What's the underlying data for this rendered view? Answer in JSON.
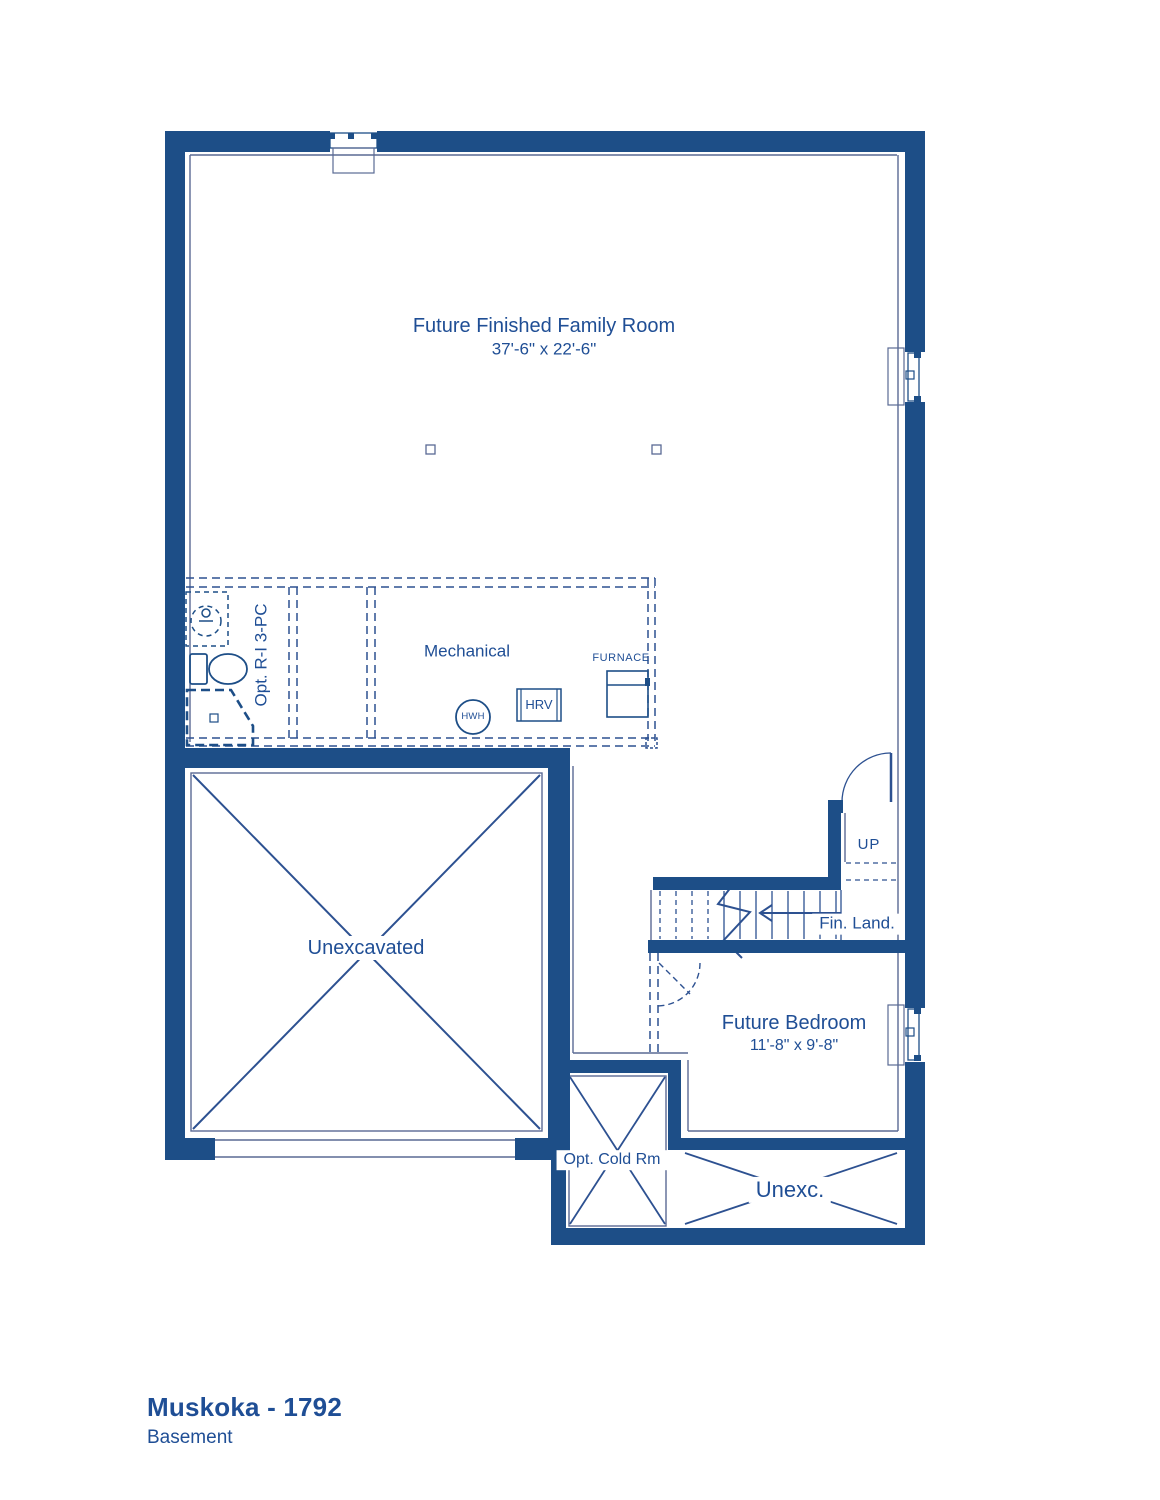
{
  "title": {
    "name": "Muskoka - 1792",
    "floor": "Basement"
  },
  "colors": {
    "wall": "#1d4e87",
    "line": "#2d5191",
    "face": "#5a6a94",
    "text": "#1f4e95"
  },
  "rooms": {
    "family_room": {
      "label": "Future Finished Family Room",
      "dims": "37'-6\" x 22'-6\""
    },
    "mechanical": {
      "label": "Mechanical"
    },
    "bath_rough_in": {
      "label": "Opt. R-I 3-PC"
    },
    "unexcavated": {
      "label": "Unexcavated"
    },
    "future_bedroom": {
      "label": "Future Bedroom",
      "dims": "11'-8\" x 9'-8\""
    },
    "cold_room": {
      "label": "Opt. Cold Rm"
    },
    "unexc_small": {
      "label": "Unexc."
    }
  },
  "equipment": {
    "furnace": "FURNACE",
    "hrv": "HRV",
    "hwh": "HWH"
  },
  "stairs": {
    "up": "UP",
    "landing": "Fin. Land."
  }
}
